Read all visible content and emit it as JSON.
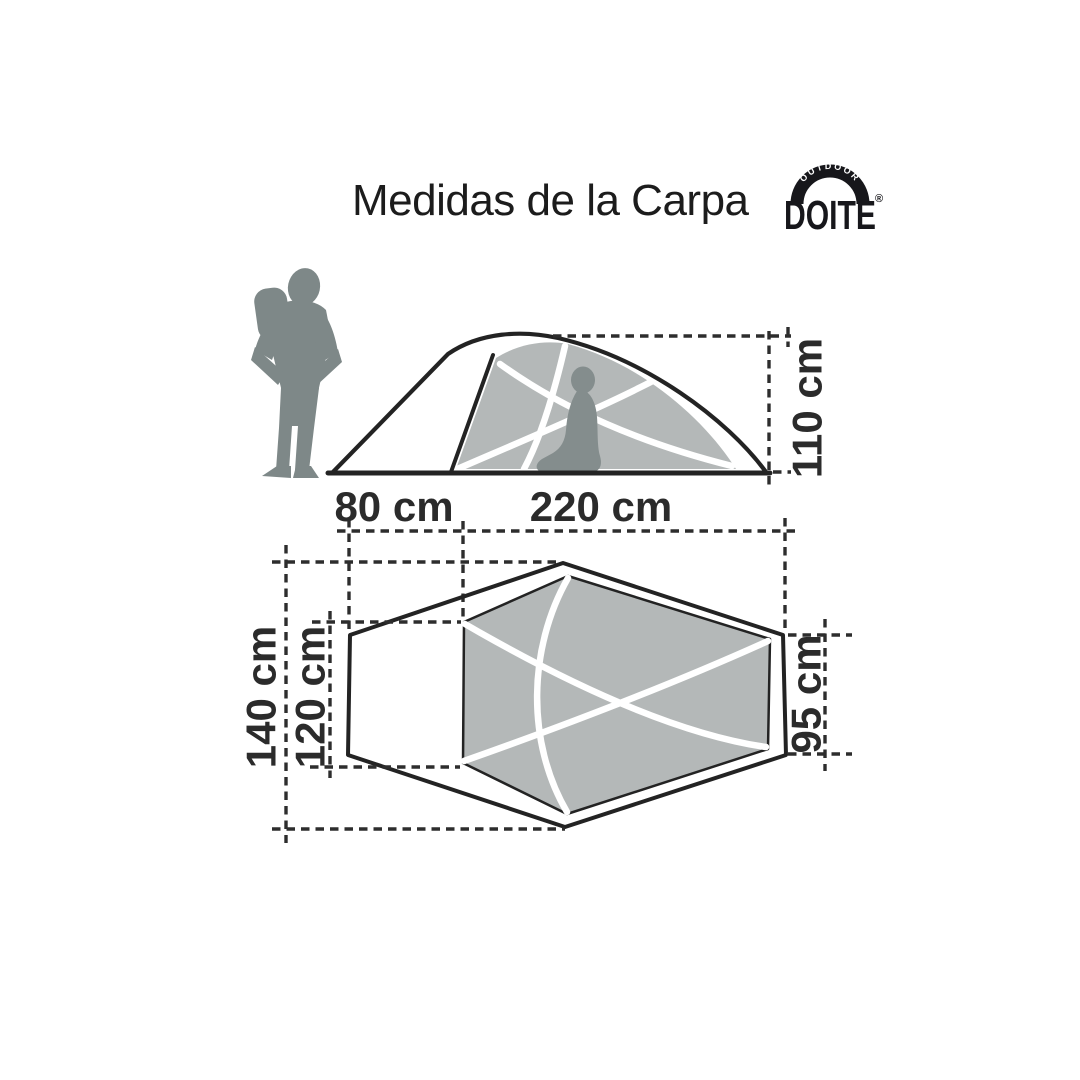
{
  "page": {
    "title": "Medidas de la Carpa",
    "background": "#ffffff"
  },
  "logo": {
    "arc_text": "OUTDOOR",
    "brand_text": "DOITE",
    "registered_mark": "®"
  },
  "dimensions": {
    "tent_height": "110 cm",
    "vestibule_depth": "80 cm",
    "floor_length": "220 cm",
    "outer_width": "140 cm",
    "inner_width": "120 cm",
    "head_width": "95 cm"
  },
  "icons": {
    "scale_person": "standing-person-silhouette",
    "occupant": "kneeling-person-silhouette"
  },
  "colors": {
    "background": "#ffffff",
    "title_ink": "#1c1c1c",
    "outline_ink": "#232323",
    "dim_ink": "#2d2d2d",
    "label_ink": "#2b2b2b",
    "fabric_gray": "#b4b8b8",
    "person_gray": "#7e8888",
    "occupant_gray": "#848d8d",
    "logo_ink": "#17171b"
  }
}
